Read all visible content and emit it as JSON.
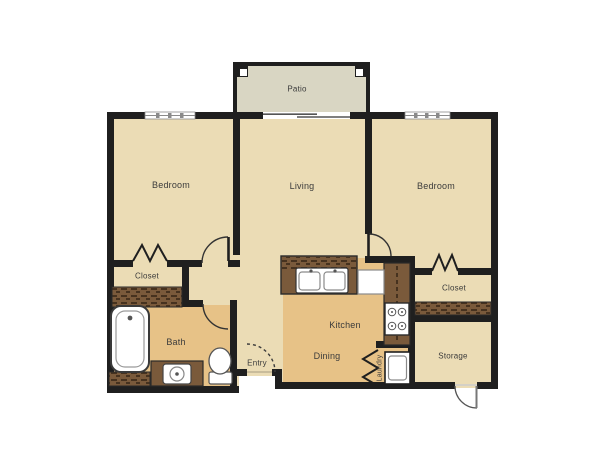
{
  "plan": {
    "type": "apartment-floor-plan",
    "rooms": {
      "patio": {
        "label": "Patio"
      },
      "bedroom_left": {
        "label": "Bedroom"
      },
      "living": {
        "label": "Living"
      },
      "bedroom_right": {
        "label": "Bedroom"
      },
      "closet_left": {
        "label": "Closet"
      },
      "closet_right": {
        "label": "Closet"
      },
      "bath": {
        "label": "Bath"
      },
      "kitchen": {
        "label": "Kitchen"
      },
      "dining": {
        "label": "Dining"
      },
      "entry": {
        "label": "Entry"
      },
      "storage": {
        "label": "Storage"
      },
      "laundry": {
        "label": "Laundry"
      }
    },
    "fixtures": [
      "bathtub",
      "vanity-sink",
      "toilet",
      "double-kitchen-sink",
      "refrigerator",
      "stove",
      "washer",
      "closet-shelf",
      "counter"
    ],
    "door_symbols": [
      "hinged-door-arc",
      "bifold-zigzag",
      "sliding-patio-door",
      "dashed-entry-door-arc",
      "exterior-storage-door-arc"
    ],
    "window_count": 2
  },
  "colors": {
    "wall": "#1f1f1f",
    "floor_main": "#ebdcb5",
    "floor_wet": "#e7c287",
    "patio_floor": "#d9d6c3",
    "casework_brown": "#7a5a3b",
    "hatch_dark": "#46321f",
    "fixture_white": "#ffffff",
    "label_text": "#3b3b3b",
    "background": "#ffffff"
  }
}
